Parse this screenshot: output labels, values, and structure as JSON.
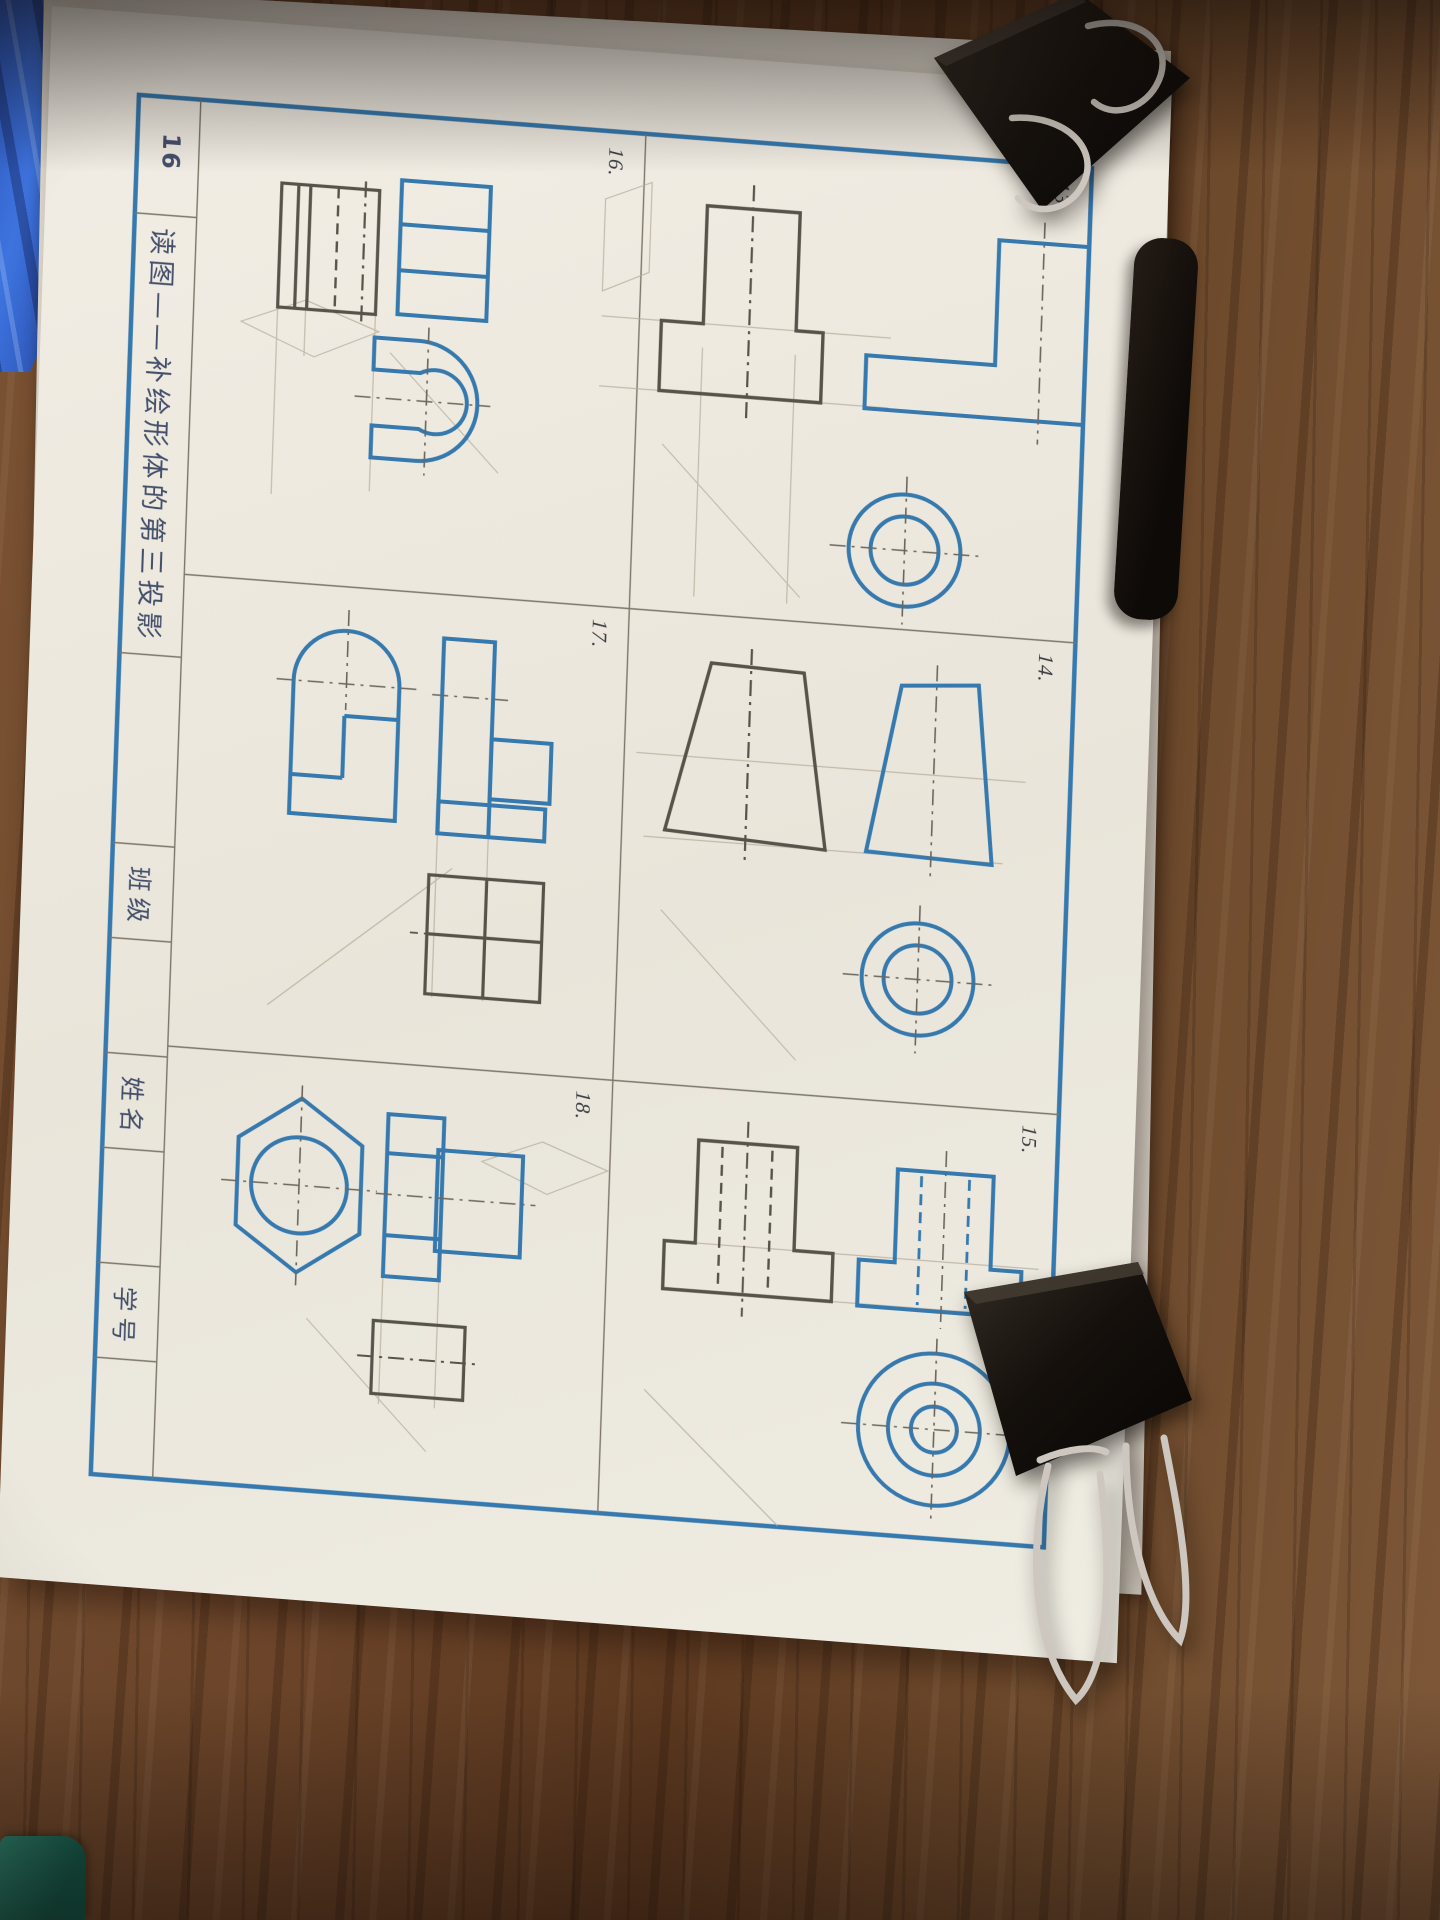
{
  "worksheet": {
    "page_number": "16",
    "title": "读图——补绘形体的第三投影",
    "fields": {
      "class_label": "班级",
      "name_label": "姓名",
      "student_id_label": "学号"
    },
    "problems": [
      {
        "label": "13."
      },
      {
        "label": "14."
      },
      {
        "label": "15."
      },
      {
        "label": "16."
      },
      {
        "label": "17."
      },
      {
        "label": "18."
      }
    ]
  },
  "colors": {
    "worksheet_blue": "#3679ae",
    "pencil_gray": "#57534b",
    "construction_gray": "#b4ab99",
    "paper": "#efece3",
    "wood_brown": "#6b4429",
    "clip_black": "#15110e",
    "clip_wire_silver": "#cdc7bf",
    "cloth_blue": "#3563cf",
    "green_object": "#236f5c"
  }
}
